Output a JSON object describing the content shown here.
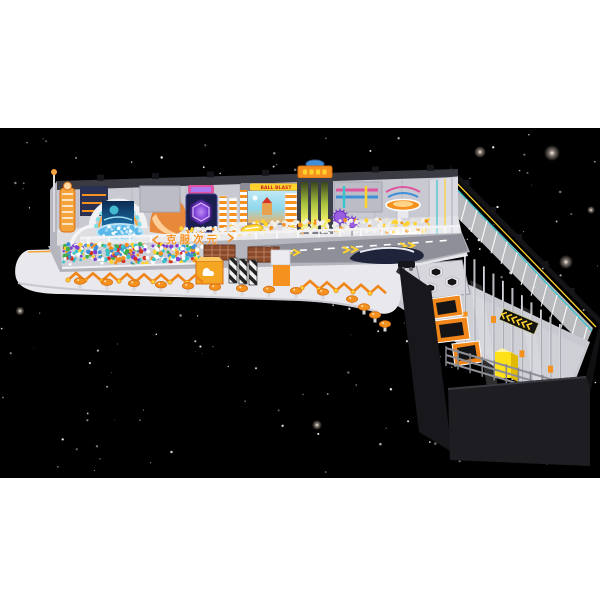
{
  "scene": {
    "description": "3D render of an L-shaped space-themed indoor playground floating on a black starfield band with white page margins",
    "background": {
      "page_color": "#ffffff",
      "space_color": "#000000",
      "space_band_top": 128,
      "space_band_height": 350,
      "star_color": "#ffffff",
      "small_star_count": 175,
      "glow_star_color": "#e8d7c8"
    },
    "signage": {
      "fascia_text": "克服次元",
      "ball_screen_title": "BALL BLAST"
    },
    "palette": {
      "orange": "#f5911e",
      "orange_dark": "#d96f12",
      "deck_gray": "#b4b5bd",
      "road_gray": "#8e8f99",
      "wall_gray": "#c9c9d2",
      "wall_top": "#3a3a42",
      "white": "#f2f1f4",
      "dark_wall": "#1d1d21",
      "teal": "#38c4cb",
      "purple": "#7b3fd4",
      "navy": "#2a2f55",
      "yellow": "#ffd22e",
      "slide_glow": "#d8e94c",
      "sky_blue": "#96d9ef",
      "ball_white": "#f1efe9",
      "pink": "#e055a0",
      "blue": "#3f8fd8",
      "green": "#3fae4c",
      "red": "#d63226",
      "brown": "#8a4a2b",
      "pool_blue": "#5ab8e8"
    },
    "equipment": [
      {
        "name": "rocket-climb-tower",
        "color": "#f5911e"
      },
      {
        "name": "rainbow-arch-gate-screen",
        "color": "#38c4cb"
      },
      {
        "name": "toddler-ball-pool",
        "color": "#5ab8e8"
      },
      {
        "name": "astronaut-mascot-slide",
        "color": "#e8883b"
      },
      {
        "name": "led-hexagon-climber",
        "color": "#7b3fd4"
      },
      {
        "name": "interactive-ball-screen",
        "color": "#ffd22e"
      },
      {
        "name": "glow-drop-slide-tower",
        "color": "#d8e94c"
      },
      {
        "name": "pipe-machinery-wall",
        "color": "#c9c9d2"
      },
      {
        "name": "spiky-planet-balls",
        "color": "#7b3fd4"
      },
      {
        "name": "spinning-disc-table",
        "color": "#f5911e"
      },
      {
        "name": "ufo-carousel",
        "color": "#38c4cb"
      },
      {
        "name": "white-ball-pit",
        "color": "#f1efe9"
      },
      {
        "name": "colorful-ball-pit-crowd",
        "color": "#d63226"
      },
      {
        "name": "storage-cubbies",
        "color": "#8a4a2b"
      },
      {
        "name": "entry-turnstile",
        "color": "#2b2b2e"
      },
      {
        "name": "logo-counter-box",
        "color": "#f5911e"
      },
      {
        "name": "spaceship-bench",
        "color": "#20243a"
      },
      {
        "name": "walkway-road",
        "color": "#8e8f99"
      },
      {
        "name": "mushroom-stools",
        "color": "#f5911e"
      },
      {
        "name": "hex-trampolines",
        "color": "#141416"
      },
      {
        "name": "orange-trampoline-lane",
        "color": "#f08519"
      },
      {
        "name": "climbing-pole-forest",
        "color": "#a9aab2"
      },
      {
        "name": "yellow-cube-slide",
        "color": "#ffe11a"
      },
      {
        "name": "perimeter-netting",
        "color": "#e6e8ee"
      },
      {
        "name": "dark-exterior-wall",
        "color": "#1d1d21"
      }
    ]
  }
}
